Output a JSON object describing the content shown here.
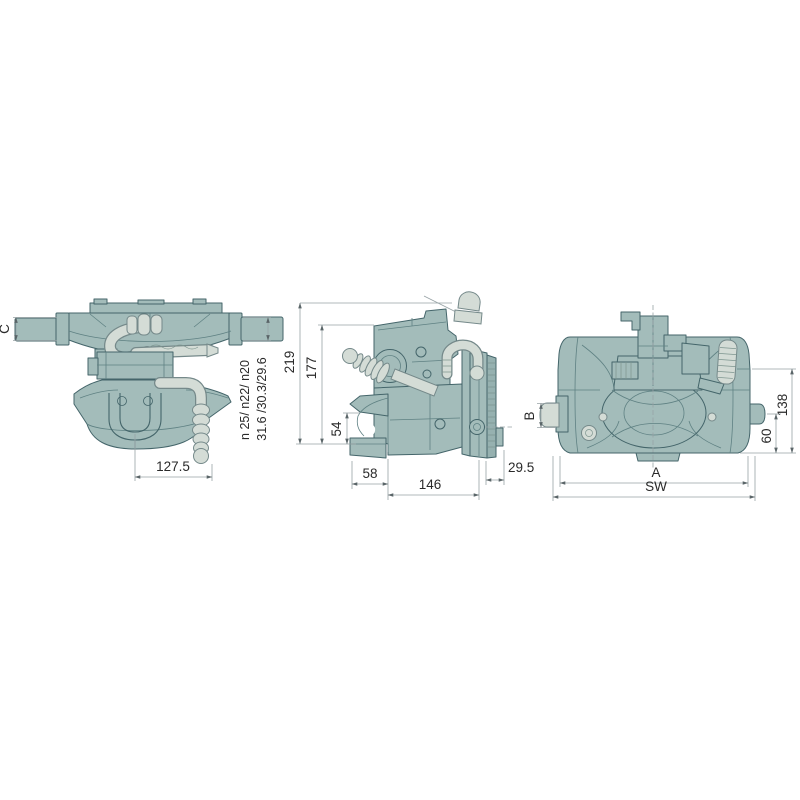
{
  "views": {
    "front": {
      "dims": {
        "c": "C",
        "pin_diameters": "n 25/ n22/ n20",
        "pin_flats": "31.6 /30.3/29.6",
        "offset_127_5": "127.5"
      }
    },
    "side": {
      "dims": {
        "height_219": "219",
        "height_177": "177",
        "height_54": "54",
        "depth_58": "58",
        "depth_146": "146",
        "flange_29_5": "29.5"
      }
    },
    "rear": {
      "dims": {
        "b": "B",
        "height_138": "138",
        "height_60": "60",
        "width_a": "A",
        "width_sw": "SW"
      }
    }
  },
  "colors": {
    "background": "#ffffff",
    "body_fill": "#a3bcba",
    "body_outline": "#44656a",
    "handle_fill": "#d4dcd6",
    "dimension_line": "#97a2a5",
    "label_text": "#2a2a2a"
  }
}
